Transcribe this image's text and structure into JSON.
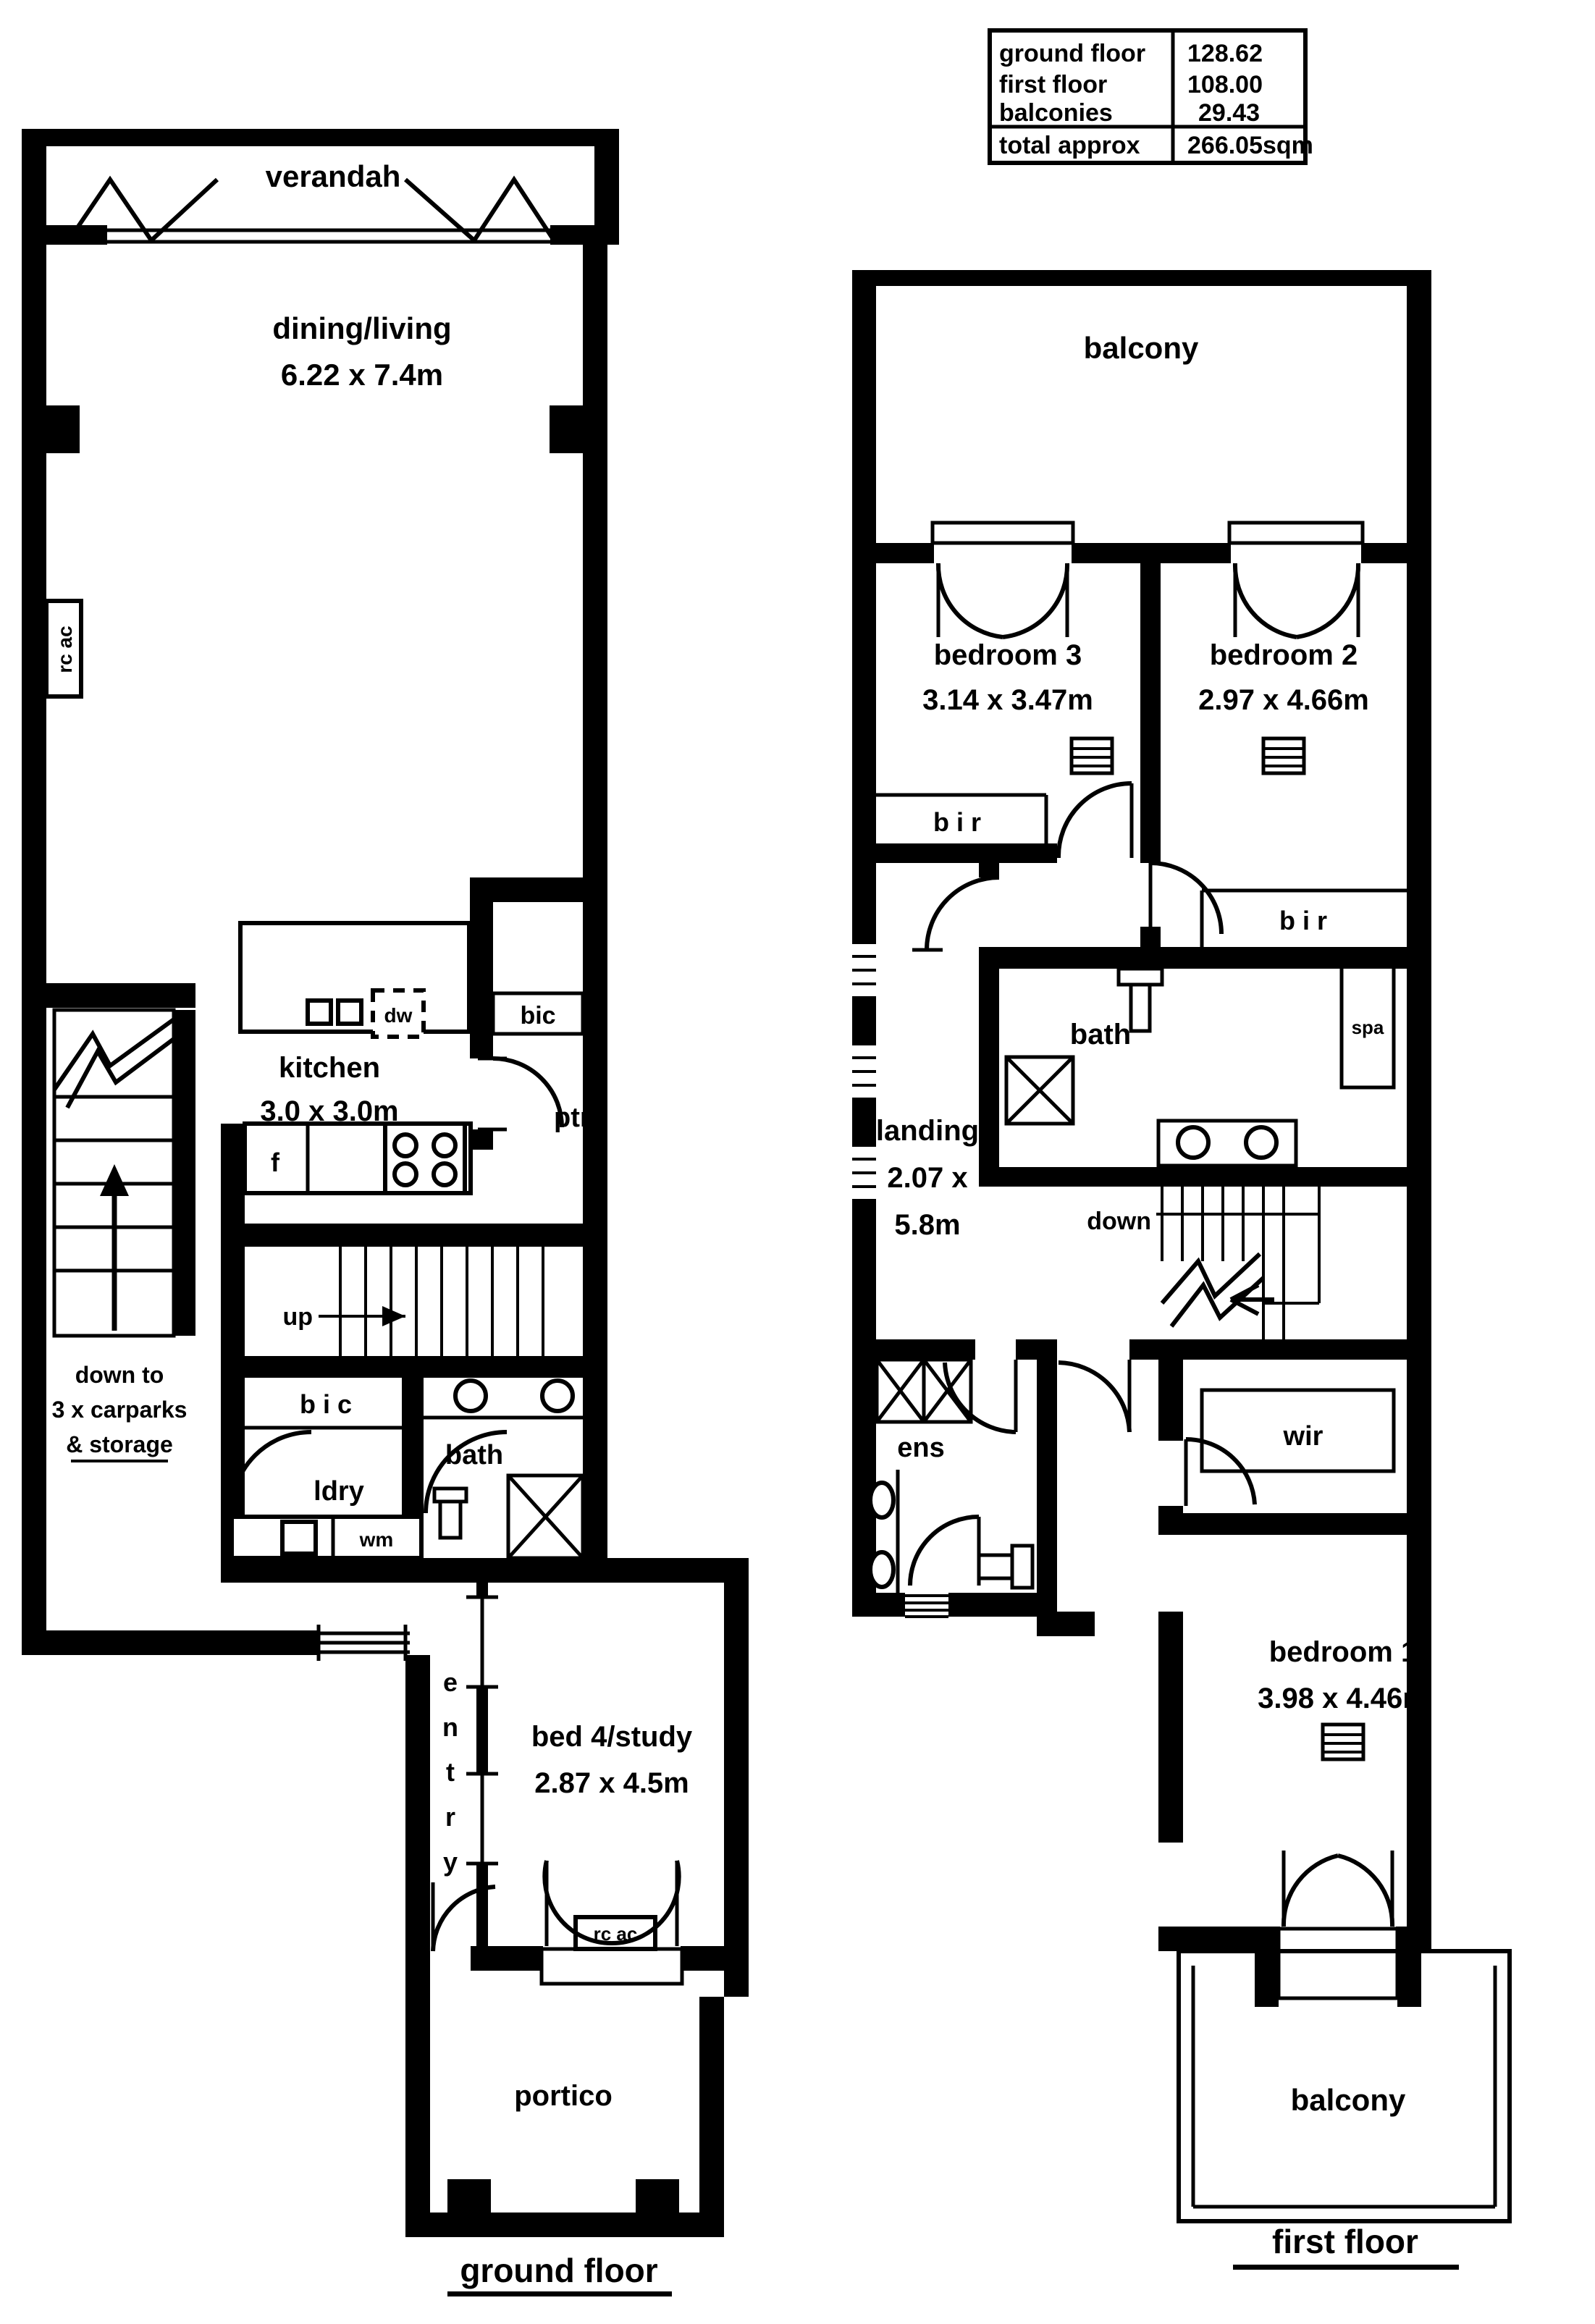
{
  "area_table": {
    "rows": [
      {
        "label": "ground floor",
        "value": "128.62"
      },
      {
        "label": "first floor",
        "value": "108.00"
      },
      {
        "label": "balconies",
        "value": " 29.43"
      },
      {
        "label": "total approx",
        "value": "266.05sqm"
      }
    ]
  },
  "ground_floor": {
    "caption": "ground floor",
    "verandah": "verandah",
    "dining": {
      "name": "dining/living",
      "dims": "6.22 x 7.4m"
    },
    "kitchen": {
      "name": "kitchen",
      "dims": "3.0 x 3.0m"
    },
    "bed4": {
      "name": "bed 4/study",
      "dims": "2.87 x 4.5m"
    },
    "labels": {
      "rc_ac_wall": "rc ac",
      "bic_upper": "bic",
      "dw": "dw",
      "ptry": "ptry",
      "f": "f",
      "up": "up",
      "down_note_1": "down to",
      "down_note_2": "3 x carparks",
      "down_note_3": "& storage",
      "bic_lower": "b i c",
      "ldry": "ldry",
      "wm": "wm",
      "bath": "bath",
      "entry": "entry",
      "rc_ac_bed": "rc ac",
      "portico": "portico"
    }
  },
  "first_floor": {
    "caption": "first floor",
    "balcony_top": "balcony",
    "balcony_bottom": "balcony",
    "bedroom3": {
      "name": "bedroom 3",
      "dims": "3.14 x 3.47m"
    },
    "bedroom2": {
      "name": "bedroom 2",
      "dims": "2.97 x 4.66m"
    },
    "bedroom1": {
      "name": "bedroom 1",
      "dims": "3.98 x 4.46m"
    },
    "landing": {
      "name": "landing",
      "dims1": "2.07 x",
      "dims2": "5.8m"
    },
    "labels": {
      "bir_bed3": "b i r",
      "bir_bed2": "b i r",
      "bath": "bath",
      "spa": "spa",
      "down": "down",
      "ens": "ens",
      "wir": "wir"
    }
  }
}
